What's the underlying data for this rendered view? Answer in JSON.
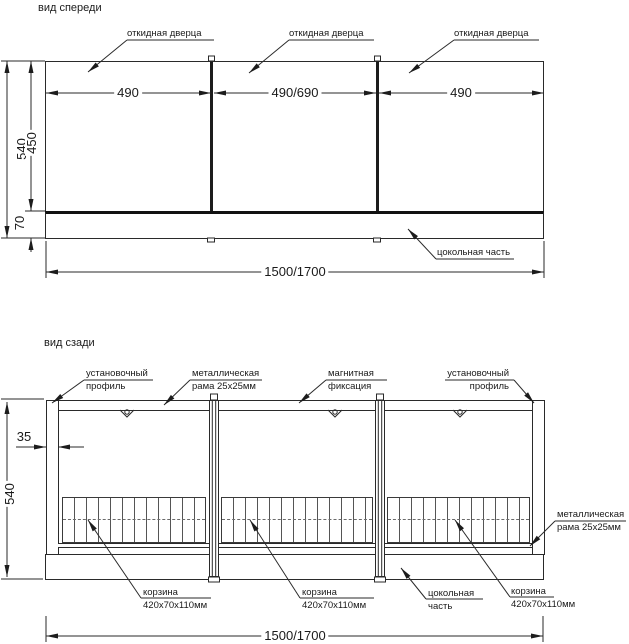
{
  "front": {
    "title": "вид спереди",
    "door_label": [
      "откидная дверца",
      "откидная дверца",
      "откидная дверца"
    ],
    "plinth_label": "цокольная часть",
    "dim_width": [
      "490",
      "490/690",
      "490"
    ],
    "dim_height_total": "540",
    "dim_height_door": "450",
    "dim_height_plinth": "70",
    "dim_total_width": "1500/1700"
  },
  "back": {
    "title": "вид сзади",
    "profile_left": [
      "установочный",
      "профиль"
    ],
    "frame_top": [
      "металлическая",
      "рама 25х25мм"
    ],
    "magnet": [
      "магнитная",
      "фиксация"
    ],
    "profile_right": [
      "установочный",
      "профиль"
    ],
    "frame_right": [
      "металлическая",
      "рама 25х25мм"
    ],
    "basket": [
      "корзина",
      "420х70х110мм"
    ],
    "plinth": [
      "цокольная",
      "часть"
    ],
    "dim_profile": "35",
    "dim_height_total": "540",
    "dim_total_width": "1500/1700"
  },
  "colors": {
    "line": "#2a2a2a",
    "thick": "#111111",
    "background": "#ffffff"
  }
}
